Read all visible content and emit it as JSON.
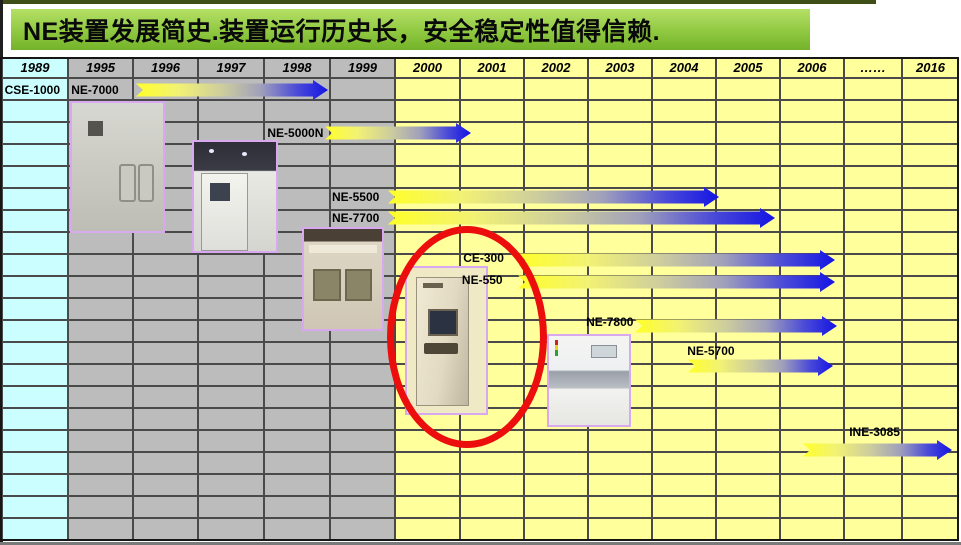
{
  "title": "NE装置发展简史.装置运行历史长，安全稳定性值得信赖.",
  "colors": {
    "title_bar_green": "#90c841",
    "top_stripe_olive": "#3f4d17",
    "column_cyan": "#cbffff",
    "column_gray": "#bcbcbc",
    "column_yellow": "#ffff9c",
    "grid_line": "#4a4a4a",
    "arrow_gradient_start": "#ffff29",
    "arrow_gradient_end": "#1414e4",
    "highlight_ellipse_red": "#ec0d0d",
    "photo_border_purple": "#d9a9ef"
  },
  "columns": [
    {
      "label": "1989",
      "group": "cyan"
    },
    {
      "label": "1995",
      "group": "gray"
    },
    {
      "label": "1996",
      "group": "gray"
    },
    {
      "label": "1997",
      "group": "gray"
    },
    {
      "label": "1998",
      "group": "gray"
    },
    {
      "label": "1999",
      "group": "gray"
    },
    {
      "label": "2000",
      "group": "yellow"
    },
    {
      "label": "2001",
      "group": "yellow"
    },
    {
      "label": "2002",
      "group": "yellow"
    },
    {
      "label": "2003",
      "group": "yellow"
    },
    {
      "label": "2004",
      "group": "yellow"
    },
    {
      "label": "2005",
      "group": "yellow"
    },
    {
      "label": "2006",
      "group": "yellow"
    },
    {
      "label": "……",
      "group": "yellow"
    },
    {
      "label": "2016",
      "group": "yellow"
    }
  ],
  "body_row_count": 21,
  "row_header": {
    "label": "CSE-1000",
    "row": 0.05,
    "u": 0.04
  },
  "timeline": {
    "products": [
      {
        "label": "NE-7000",
        "label_row": 0.05,
        "label_u": 1.05,
        "label_align": "left",
        "arrow": {
          "row": 0.05,
          "start_u": 2.05,
          "end_u": 4.97
        }
      },
      {
        "label": "NE-5000N",
        "label_row": 1.98,
        "label_u": 4.9,
        "label_align": "right",
        "arrow": {
          "row": 1.98,
          "start_u": 4.92,
          "end_u": 7.16
        }
      },
      {
        "label": "NE-5500",
        "label_row": 4.9,
        "label_u": 5.03,
        "label_align": "left",
        "arrow": {
          "row": 4.9,
          "start_u": 5.89,
          "end_u": 11.05
        }
      },
      {
        "label": "NE-7700",
        "label_row": 5.85,
        "label_u": 5.03,
        "label_align": "left",
        "arrow": {
          "row": 5.85,
          "start_u": 5.89,
          "end_u": 11.92
        }
      },
      {
        "label": "CE-300",
        "label_row": 7.7,
        "label_u": 7.05,
        "label_align": "left",
        "arrow": {
          "row": 7.77,
          "start_u": 7.91,
          "end_u": 12.86
        }
      },
      {
        "label": "NE-550",
        "label_row": 8.7,
        "label_u": 7.03,
        "label_align": "left",
        "arrow": {
          "row": 8.77,
          "start_u": 7.91,
          "end_u": 12.86
        }
      },
      {
        "label": "NE-7800",
        "label_row": 10.6,
        "label_u": 8.97,
        "label_align": "left",
        "arrow": {
          "row": 10.75,
          "start_u": 9.73,
          "end_u": 12.89
        }
      },
      {
        "label": "NE-5700",
        "label_row": 11.9,
        "label_u": 10.55,
        "label_align": "left",
        "arrow": {
          "row": 12.6,
          "start_u": 10.56,
          "end_u": 12.83
        }
      },
      {
        "label": "INE-3085",
        "label_row": 15.6,
        "label_u": 13.09,
        "label_align": "left",
        "arrow": {
          "row": 16.4,
          "start_u": 12.36,
          "end_u": 14.88
        }
      }
    ]
  },
  "chart_data": {
    "type": "bar",
    "subtype": "gantt-timeline",
    "title": "NE装置发展简史.装置运行历史长，安全稳定性值得信赖.",
    "x_tick_labels": [
      "1989",
      "1995",
      "1996",
      "1997",
      "1998",
      "1999",
      "2000",
      "2001",
      "2002",
      "2003",
      "2004",
      "2005",
      "2006",
      "……",
      "2016"
    ],
    "first_column_value": "CSE-1000",
    "bars": [
      {
        "label": "NE-7000",
        "start_year": 1996,
        "end_year": 1999
      },
      {
        "label": "NE-5000N",
        "start_year": 1999,
        "end_year": 2001
      },
      {
        "label": "NE-5500",
        "start_year": 2000,
        "end_year": 2004
      },
      {
        "label": "NE-7700",
        "start_year": 2000,
        "end_year": 2005
      },
      {
        "label": "CE-300",
        "start_year": 2002,
        "end_year": 2006
      },
      {
        "label": "NE-550",
        "start_year": 2002,
        "end_year": 2006
      },
      {
        "label": "NE-7800",
        "start_year": 2003,
        "end_year": 2006
      },
      {
        "label": "NE-5700",
        "start_year": 2004,
        "end_year": 2006
      },
      {
        "label": "INE-3085",
        "start_year": 2006,
        "end_year": 2016
      }
    ],
    "bar_style": "yellow-to-blue gradient right arrows with notched tails",
    "legend": "none",
    "grid": true,
    "annotations": [
      "red ellipse highlighting the NE-550 machine photo"
    ]
  }
}
